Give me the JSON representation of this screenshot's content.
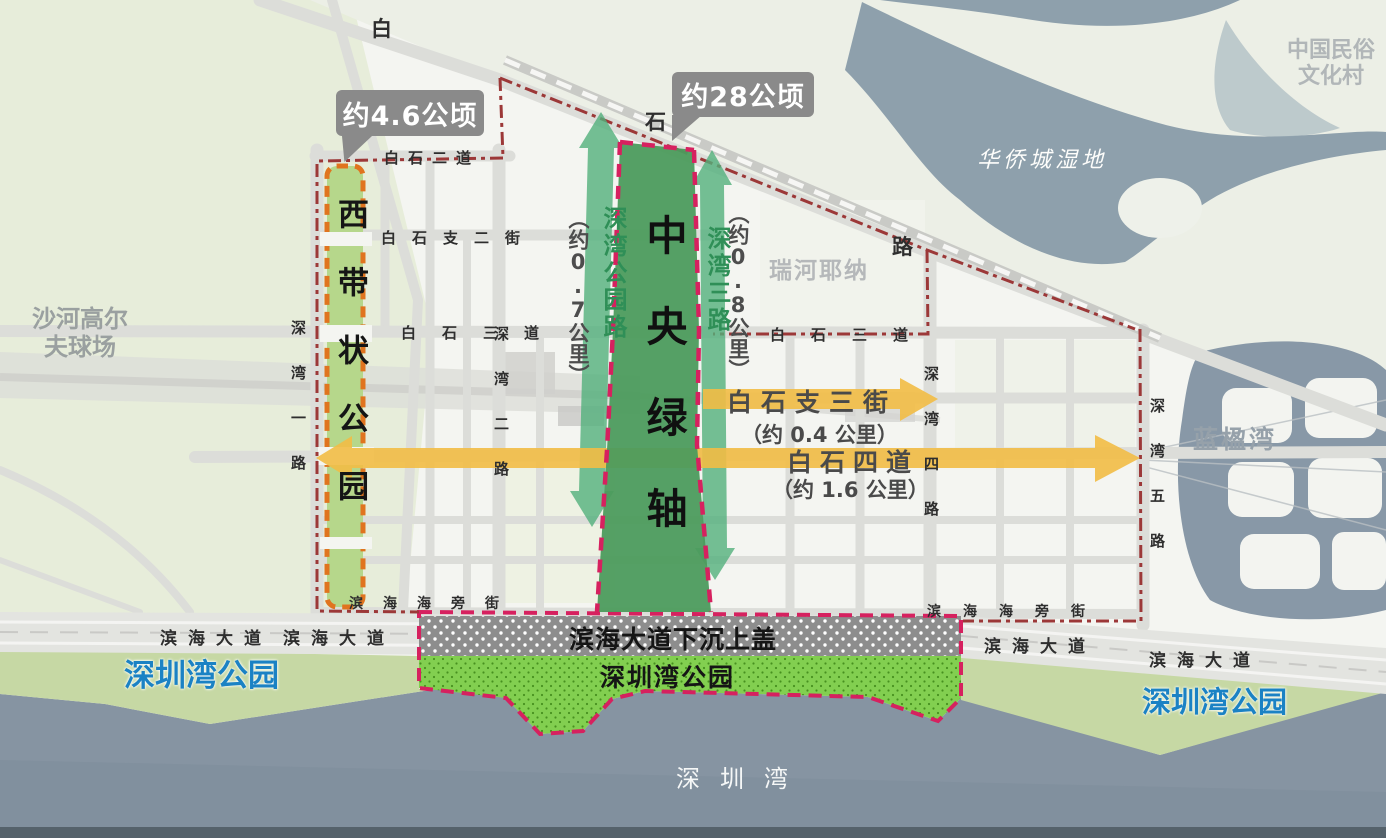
{
  "callouts": {
    "west_belt_area": "约4.6公顷",
    "central_axis_area": "约28公顷"
  },
  "parks": {
    "west_belt_vertical": "西带状公园",
    "central_axis_vertical": "中央绿轴",
    "binhai_cover": "滨海大道下沉上盖",
    "bay_park_inside": "深圳湾公园",
    "bay_park_west": "深圳湾公园",
    "bay_park_east": "深圳湾公园"
  },
  "green_routes": {
    "shenwan_park_road": {
      "name": "深湾公园路",
      "length": "（约0.7公里）"
    },
    "shenwan_3rd": {
      "name": "深湾三路",
      "length": "（约0.8公里）"
    }
  },
  "yellow_routes": {
    "baishi_branch_3rd": {
      "name": "白石支三街",
      "length": "（约 0.4 公里）"
    },
    "baishi_4th": {
      "name": "白石四道",
      "length": "（约 1.6 公里）"
    }
  },
  "roads": {
    "bai": "白",
    "shi": "石",
    "lu": "路",
    "baishi_2nd": "白石二道",
    "baishi_branch_2nd": "白石支二街",
    "baishi_3rd_w": "白石三道",
    "baishi_3rd_e": "白石三道",
    "shenwan_1st": "深湾一路",
    "shenwan_2nd": "深湾二路",
    "shenwan_4th": "深湾四路",
    "shenwan_5th": "深湾五路",
    "haipang_w": "滨海海旁街",
    "haipang_e": "滨海海旁街",
    "binhai_dadao_l1": "滨海大道",
    "binhai_dadao_l2": "滨海大道",
    "binhai_dadao_r1": "滨海大道",
    "binhai_dadao_r2": "滨海大道"
  },
  "places": {
    "golf_line1": "沙河高尔",
    "golf_line2": "夫球场",
    "folk_line1": "中国民俗",
    "folk_line2": "文化村",
    "wetland": "华侨城湿地",
    "ruihe": "瑞河耶纳",
    "lanying": "蓝楹湾",
    "bay": "深圳湾"
  },
  "colors": {
    "boundary_red": "#9c3838",
    "boundary_magenta": "#d6215f",
    "belt_orange": "#e0741f",
    "belt_green": "#b6d78b",
    "axis_green": "#4c9b5d",
    "arrow_green": "#52b07c",
    "arrow_yellow": "#f2bd45",
    "park_dot_green": "#82cf50",
    "cover_gray": "#8d8d8d",
    "water_blue": "#8694a2",
    "label_blue": "#1b82c4"
  }
}
